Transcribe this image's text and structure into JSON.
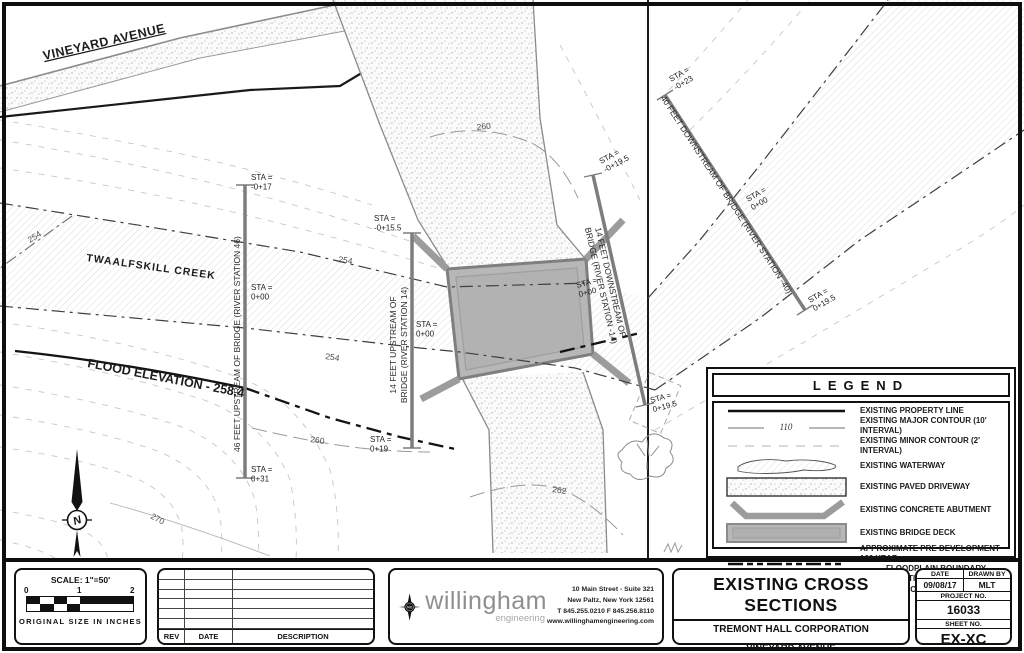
{
  "sheet": {
    "bg": "#ffffff",
    "border_color": "#0e0e0e"
  },
  "map": {
    "road_label": "VINEYARD AVENUE",
    "creek_label": "TWAALFSKILL CREEK",
    "flood_label": "FLOOD ELEVATION - 258.4",
    "north_letter": "N",
    "sta_prefix": "STA =",
    "contour_labels": [
      "254",
      "254",
      "254",
      "260",
      "260",
      "262",
      "270"
    ],
    "sections": [
      {
        "name_line1": "46 FEET UPSTREAM OF BRIDGE (RIVER STATION 46)",
        "name_line2": "",
        "sta": [
          "-0+17",
          "0+00",
          "0+31"
        ]
      },
      {
        "name_line1": "14 FEET UPSTREAM OF",
        "name_line2": "BRIDGE (RIVER STATION 14)",
        "sta": [
          "-0+15.5",
          "0+00",
          "0+19"
        ]
      },
      {
        "name_line1": "14 FEET DOWNSTREAM OF",
        "name_line2": "BRIDGE (RIVER STATION -14)",
        "sta": [
          "-0+19.5",
          "0+00",
          "0+19.5"
        ]
      },
      {
        "name_line1": "40 FEET DOWNSTREAM OF BRIDGE (RIVER STATION -40)",
        "name_line2": "",
        "sta": [
          "-0+23",
          "0+00",
          "0+19.5"
        ]
      }
    ]
  },
  "legend": {
    "title": "LEGEND",
    "items": [
      {
        "label": "EXISTING PROPERTY LINE"
      },
      {
        "label": "EXISTING MAJOR CONTOUR (10' INTERVAL)",
        "sample": "110"
      },
      {
        "label": "EXISTING MINOR CONTOUR (2' INTERVAL)"
      },
      {
        "label": "EXISTING WATERWAY"
      },
      {
        "label": "EXISTING PAVED DRIVEWAY"
      },
      {
        "label": "EXISTING CONCRETE ABUTMENT"
      },
      {
        "label": "EXISTING BRIDGE DECK"
      },
      {
        "label": "APPROXIMATE PRE DEVELOPMENT 100 YEAR",
        "label2": "FLOODPLAIN BOUNDARY LOCATION"
      },
      {
        "label": "HEC-RAS CROSS SECTION"
      }
    ]
  },
  "scalebox": {
    "scale_text": "SCALE: 1\"=50'",
    "ticks": [
      "0",
      "1",
      "2"
    ],
    "caption": "ORIGINAL SIZE IN INCHES"
  },
  "revtable": {
    "headers": [
      "REV",
      "DATE",
      "DESCRIPTION"
    ]
  },
  "firm": {
    "logo_text": "we",
    "name": "willingham",
    "tagline": "engineering",
    "address1": "10 Main Street - Suite 321",
    "address2": "New Paltz, New York 12561",
    "address3": "T 845.255.0210  F 845.256.8110",
    "address4": "www.willinghamengineering.com"
  },
  "titleblock": {
    "title": "EXISTING CROSS SECTIONS",
    "client": "TREMONT HALL CORPORATION",
    "location1": "VINEYARD AVENUE",
    "location2": "TOWN OF LLOYD, ULSTER COUNTY, NEW YORK"
  },
  "infoblock": {
    "date_label": "DATE",
    "date": "09/08/17",
    "drawn_label": "DRAWN BY",
    "drawn_by": "MLT",
    "project_label": "PROJECT NO.",
    "project_no": "16033",
    "sheet_label": "SHEET NO.",
    "sheet_no": "EX-XC"
  },
  "colors": {
    "deck_fill": "#b7b7b7",
    "abutment_gray": "#9c9c9c",
    "section_gray": "#7d7d7d"
  }
}
